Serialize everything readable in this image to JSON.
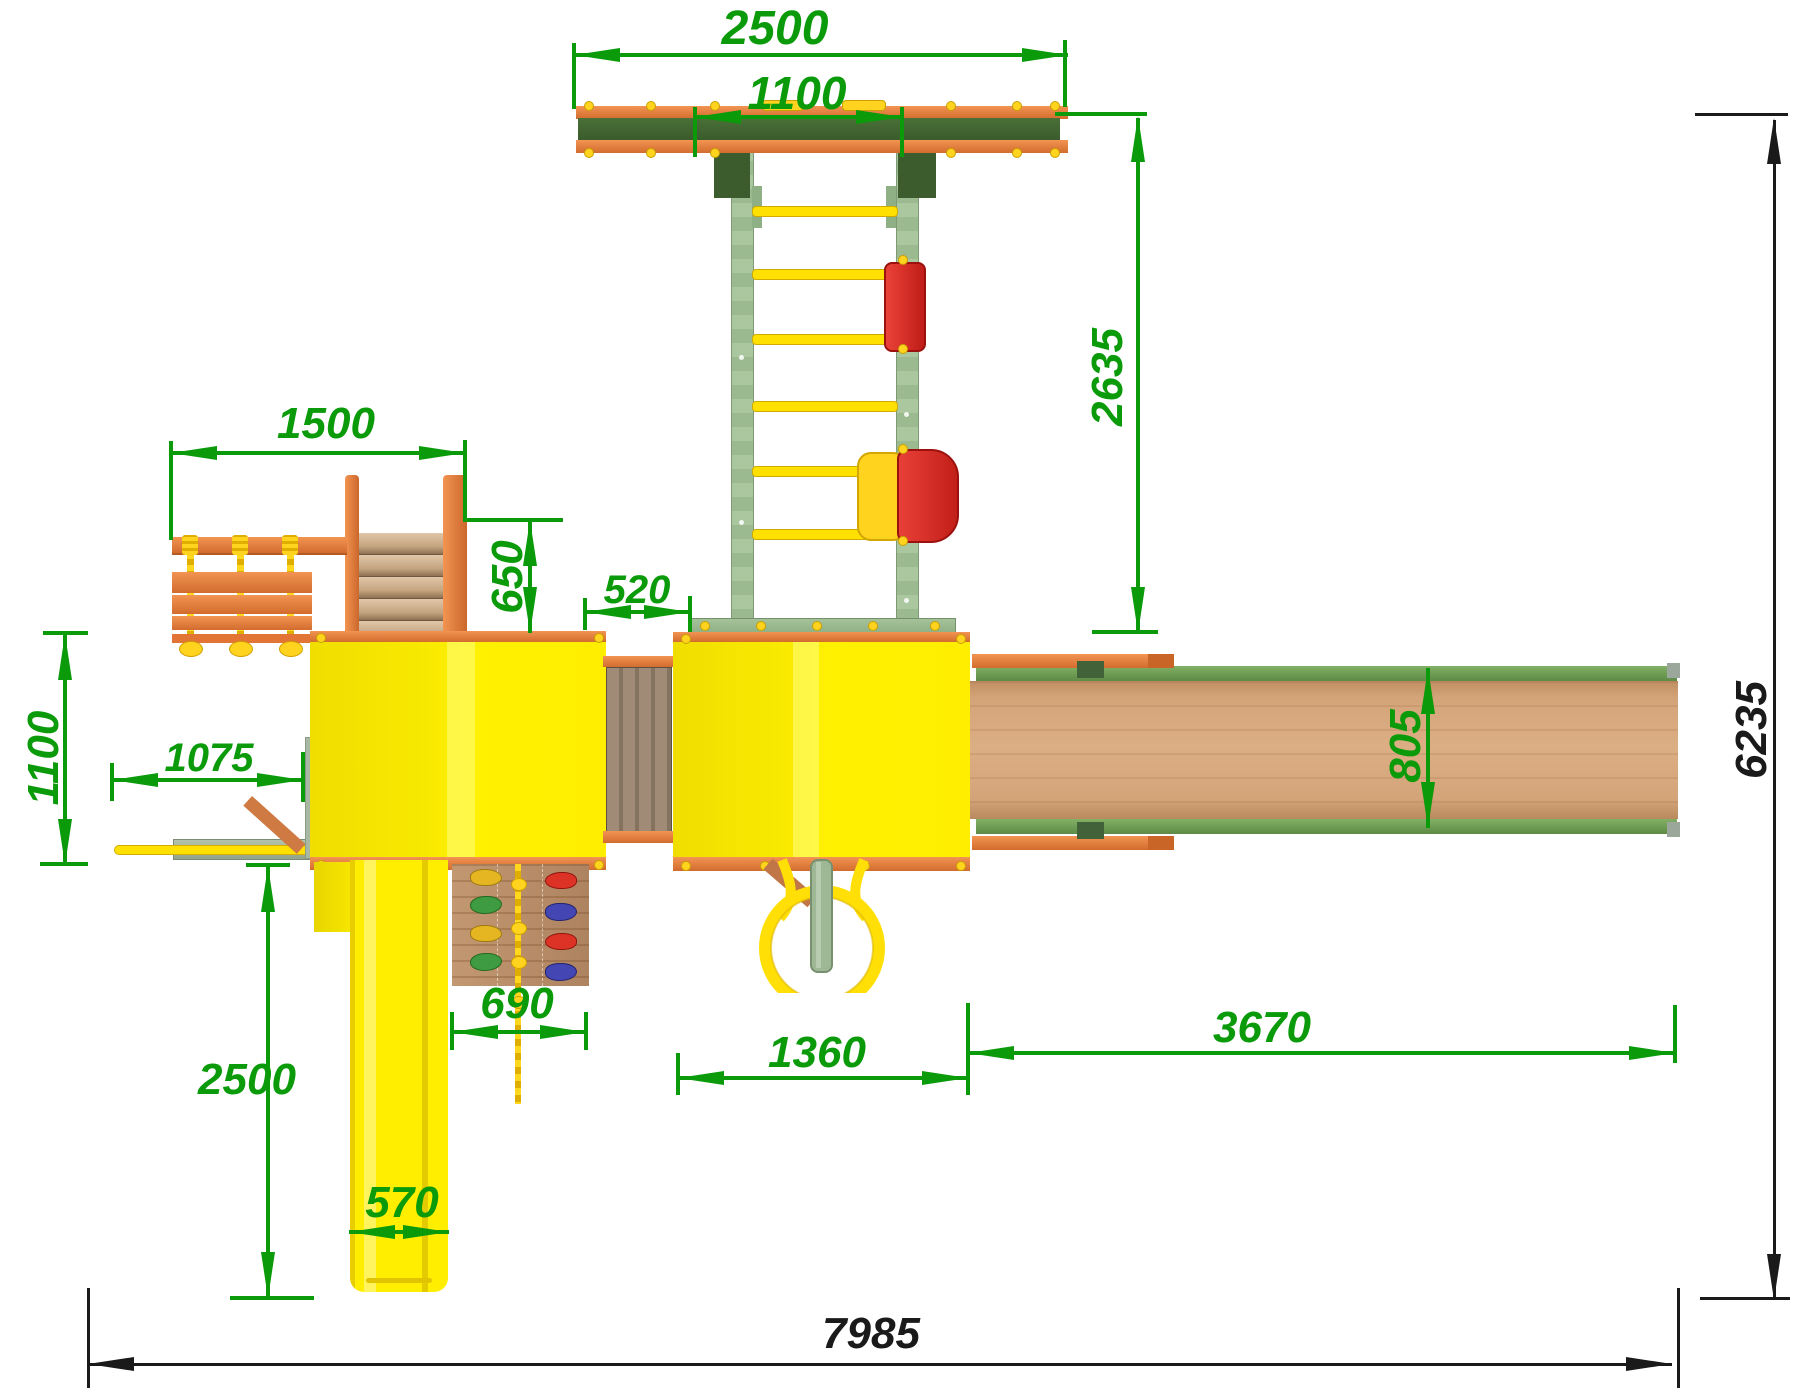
{
  "drawing": {
    "kind": "playground-set-top-view-plan",
    "units": "mm"
  },
  "dimensions": {
    "swing_beam_width": "2500",
    "swing_rail_span": "1100",
    "swing_frame_depth": "2635",
    "rope_ladder_beam": "1500",
    "stair_depth": "650",
    "bridge_width": "520",
    "side_overhang": "1100",
    "balance_beam_reach": "1075",
    "small_slide_run": "2500",
    "small_slide_width": "570",
    "climbing_wall_width": "690",
    "tower_width": "1360",
    "big_slide_length": "3670",
    "big_slide_width": "805",
    "overall_depth": "6235",
    "overall_width": "7985"
  },
  "colors": {
    "dimension_green": "#0a9a0a",
    "dimension_black": "#1a1a1a",
    "platform_yellow": "#ffee00",
    "wood_orange": "#e8834a",
    "beam_dark_green": "#42633a",
    "rail_light_green": "#a5c29a",
    "slide_wood": "#d2a277",
    "slide_edge_green": "#6f9e56",
    "seat_red": "#e03028",
    "accent_yellow": "#ffd31e",
    "bridge_wood": "#9e8a74"
  },
  "components": [
    "swing-beam",
    "gladiator-ladder",
    "flat-swing-seat",
    "baby-swing-seat",
    "hanging-rope-ladder",
    "wooden-stairs",
    "tower-platform-1",
    "tower-platform-2",
    "wooden-bridge",
    "climbing-wall",
    "climbing-rope",
    "small-slide",
    "big-slide",
    "tire-swing",
    "balance-beam"
  ]
}
